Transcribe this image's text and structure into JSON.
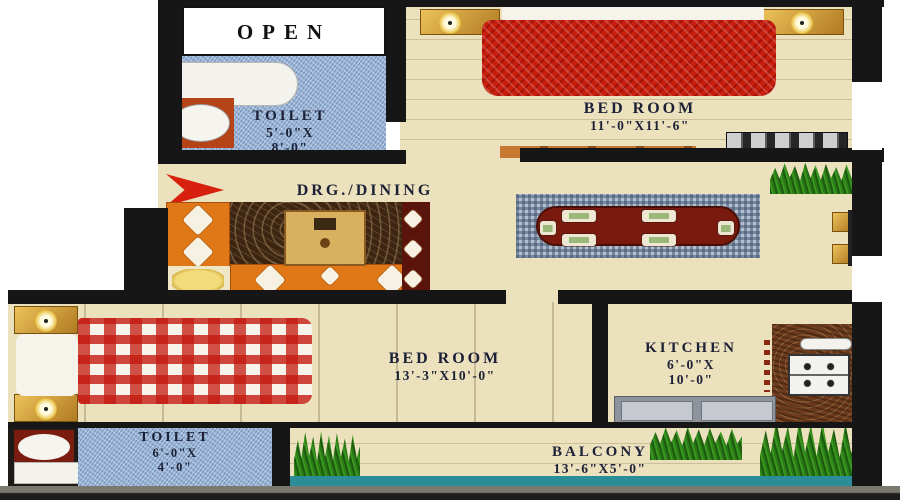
{
  "rooms": {
    "open": {
      "name": "OPEN"
    },
    "toilet_top": {
      "name": "TOILET",
      "dim1": "5'-0\"X",
      "dim2": "8'-0\""
    },
    "bedroom_top": {
      "name": "BED ROOM",
      "dims": "11'-0\"X11'-6\""
    },
    "drg_dining": {
      "name": "DRG./DINING",
      "dims": "16'-3\" X 10'-0\""
    },
    "bedroom_bottom": {
      "name": "BED ROOM",
      "dims": "13'-3\"X10'-0\""
    },
    "kitchen": {
      "name": "KITCHEN",
      "dim1": "6'-0\"X",
      "dim2": "10'-0\""
    },
    "toilet_bottom": {
      "name": "TOILET",
      "dim1": "6'-0\"X",
      "dim2": "4'-0\""
    },
    "balcony": {
      "name": "BALCONY",
      "dims": "13'-6\"X5'-0\""
    }
  },
  "icons": {
    "entry_arrow": "entry-direction-arrow",
    "plants": "potted-plant",
    "lamps": "table-lamp",
    "bathtub": "bathtub",
    "wc": "toilet-seat",
    "stove": "gas-stove",
    "sink": "kitchen-sink"
  },
  "colors": {
    "wall": "#161616",
    "floor": "#ece1bd",
    "toilet_floor": "#9db8d8",
    "bed_red": "#c81e0e",
    "bed_gingham_red": "#c3190f",
    "sofa_orange": "#e07818",
    "dining_table_maroon": "#7a1a0e",
    "rug_brown": "#3c2612",
    "rug_check_blue": "#b2bfce",
    "plant_green": "#2e8a1a",
    "balcony_teal": "#2b8d98",
    "entry_arrow_red": "#d8200e"
  }
}
